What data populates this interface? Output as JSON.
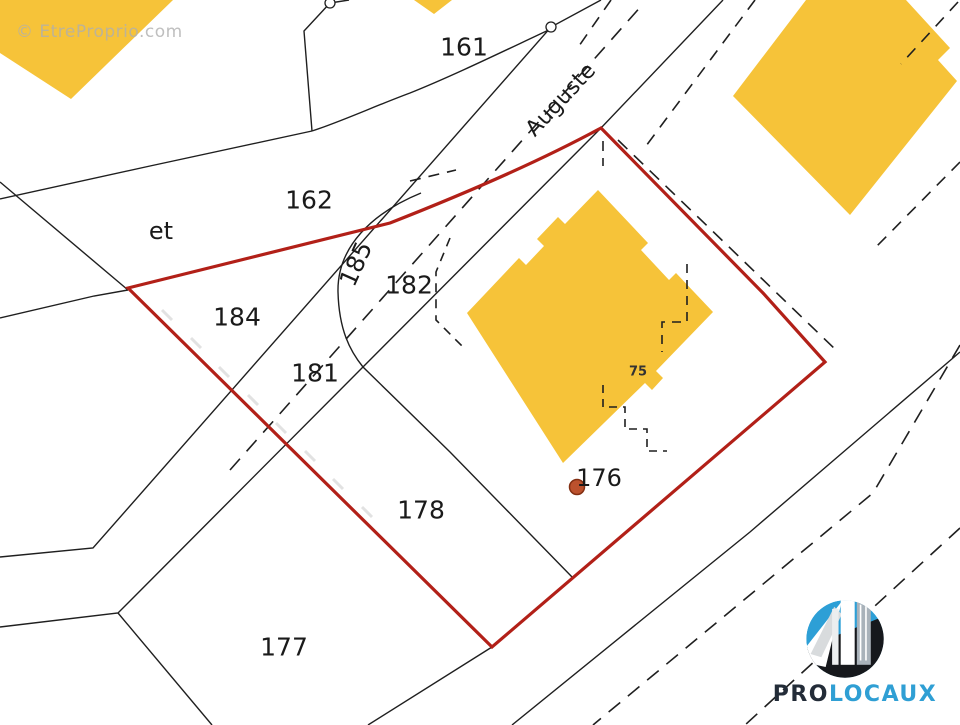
{
  "map": {
    "watermark": "© EtreProprio.com",
    "colors": {
      "background": "#ffffff",
      "building_fill": "#F6C339",
      "line": "#1f1f1f",
      "boundary_red": "#b22018",
      "label": "#1a1a1a",
      "small_label": "#333333",
      "tick": "#e2e2e2",
      "dot_fill": "#bc512d",
      "dot_stroke": "#832f12",
      "junction_fill": "#ffffff"
    },
    "parcel_labels": [
      {
        "text": "161",
        "x": 464,
        "y": 47,
        "size": 25,
        "rotate": 0
      },
      {
        "text": "162",
        "x": 309,
        "y": 200,
        "size": 25,
        "rotate": 0
      },
      {
        "text": "et",
        "x": 161,
        "y": 231,
        "size": 24,
        "rotate": 0
      },
      {
        "text": "184",
        "x": 237,
        "y": 317,
        "size": 25,
        "rotate": 0
      },
      {
        "text": "185",
        "x": 356,
        "y": 264,
        "size": 24,
        "rotate": -66
      },
      {
        "text": "182",
        "x": 409,
        "y": 285,
        "size": 25,
        "rotate": 0
      },
      {
        "text": "181",
        "x": 315,
        "y": 373,
        "size": 25,
        "rotate": 0
      },
      {
        "text": "178",
        "x": 421,
        "y": 510,
        "size": 25,
        "rotate": 0
      },
      {
        "text": "177",
        "x": 284,
        "y": 647,
        "size": 25,
        "rotate": 0
      },
      {
        "text": "176",
        "x": 599,
        "y": 478,
        "size": 24,
        "rotate": 0
      },
      {
        "text": "75",
        "x": 638,
        "y": 372,
        "size": 13,
        "rotate": 0,
        "bold": true,
        "small": true
      }
    ],
    "street_label": {
      "text": "Auguste",
      "x": 561,
      "y": 100,
      "size": 22,
      "rotate": -47
    },
    "buildings": [
      {
        "name": "building-top-left",
        "points": "0,0 173,0 71,99 0,53"
      },
      {
        "name": "building-top-center",
        "points": "414,0 452,0 434,14"
      },
      {
        "name": "building-top-right",
        "points": "806,0 906,0 950,48 938,60 957,81 850,215 733,96"
      },
      {
        "name": "building-central",
        "points": "598,190 648,243 641,250 669,280 676,273 713,312 656,371 663,378 652,390 645,383 563,463 467,313 519,258 526,265 544,246 537,239 558,217 565,224"
      }
    ],
    "solid_lines": [
      {
        "name": "road-west-edge",
        "points": "0,557 93,548 551,27 601,0"
      },
      {
        "name": "road-east-edge",
        "points": "0,627 118,613 601,128 723,0"
      },
      {
        "name": "parcel-line-et-north",
        "points": "0,182 128,290"
      },
      {
        "name": "parcel-line-et-south",
        "points": "0,318 94,296 128,290"
      },
      {
        "name": "parcel-line-162-north",
        "points": "0,199 150,166 312,131"
      },
      {
        "name": "parcel-line-161-west",
        "points": "330,3 304,31 312,131"
      },
      {
        "name": "parcel-line-161-top",
        "points": "330,3 349,0"
      },
      {
        "name": "parcel-line-177-west",
        "points": "118,613 212,725"
      },
      {
        "name": "road-edge-south",
        "points": "492,647 368,725"
      },
      {
        "name": "second-road-edge",
        "points": "960,352 750,532 512,725"
      }
    ],
    "curve_paths": [
      {
        "name": "parcel-curve-161",
        "d": "M553,28 C510,48 455,75 410,93 C375,106 340,122 312,131"
      },
      {
        "name": "parcel-curve-185",
        "d": "M421,193 C372,213 337,247 338,292 C339,330 350,351 363,367 L450,452 L573,578"
      }
    ],
    "dashed_lines": [
      {
        "name": "road-centerline",
        "d": "M230,470 L643,4",
        "dash": "15 10"
      },
      {
        "name": "dash-segment-162",
        "d": "M410,181 L456,170",
        "dash": "11 8"
      },
      {
        "name": "building-overhang-west",
        "d": "M450,238 L436,272 L436,320 L466,350",
        "dash": "9 7"
      },
      {
        "name": "dash-parallel-red",
        "d": "M618,140 L838,352",
        "dash": "13 9"
      },
      {
        "name": "dash-below-peak",
        "d": "M603,141 L603,166",
        "dash": "10 7"
      },
      {
        "name": "building-overhang-east",
        "d": "M687,264 L687,322 L662,322 L662,352",
        "dash": "9 7"
      },
      {
        "name": "building-steps-south",
        "d": "M603,385 L603,407 L625,407 L625,429 L647,429 L647,451 L667,451",
        "dash": "8 6"
      },
      {
        "name": "dash-northeast-1",
        "d": "M755,0 L643,150",
        "dash": "12 9"
      },
      {
        "name": "dash-northeast-2",
        "d": "M611,0 L579,46",
        "dash": "12 9"
      },
      {
        "name": "dash-topright-1",
        "d": "M958,2 L901,64",
        "dash": "12 9"
      },
      {
        "name": "dash-topright-2",
        "d": "M960,162 L876,247",
        "dash": "12 9"
      },
      {
        "name": "second-road-dash-1",
        "d": "M960,345 L873,493 L593,725",
        "dash": "15 10"
      },
      {
        "name": "second-road-dash-2",
        "d": "M960,528 L745,725",
        "dash": "15 10"
      }
    ],
    "red_boundary": {
      "d": "M128,288 L390,223 Q520,172 601,128 L763,293 L825,362 L492,647 Z",
      "width": 3.2
    },
    "hatch_ticks": [
      [
        162,
        310,
        172,
        320
      ],
      [
        191,
        338,
        201,
        348
      ],
      [
        219,
        367,
        229,
        377
      ],
      [
        248,
        395,
        258,
        405
      ],
      [
        276,
        423,
        286,
        433
      ],
      [
        305,
        451,
        315,
        461
      ],
      [
        333,
        479,
        343,
        489
      ],
      [
        362,
        507,
        372,
        517
      ]
    ],
    "junctions": [
      {
        "x": 330,
        "y": 3,
        "r": 5
      },
      {
        "x": 551,
        "y": 27,
        "r": 5
      }
    ],
    "marker_dot": {
      "x": 577,
      "y": 487,
      "r": 7.5
    }
  },
  "logo": {
    "pro": "PRO",
    "locaux": "LOCAUX",
    "pro_color": "#232c38",
    "locaux_color": "#2f9fd4",
    "blue": "#2d9fd6",
    "dark": "#16181c"
  }
}
